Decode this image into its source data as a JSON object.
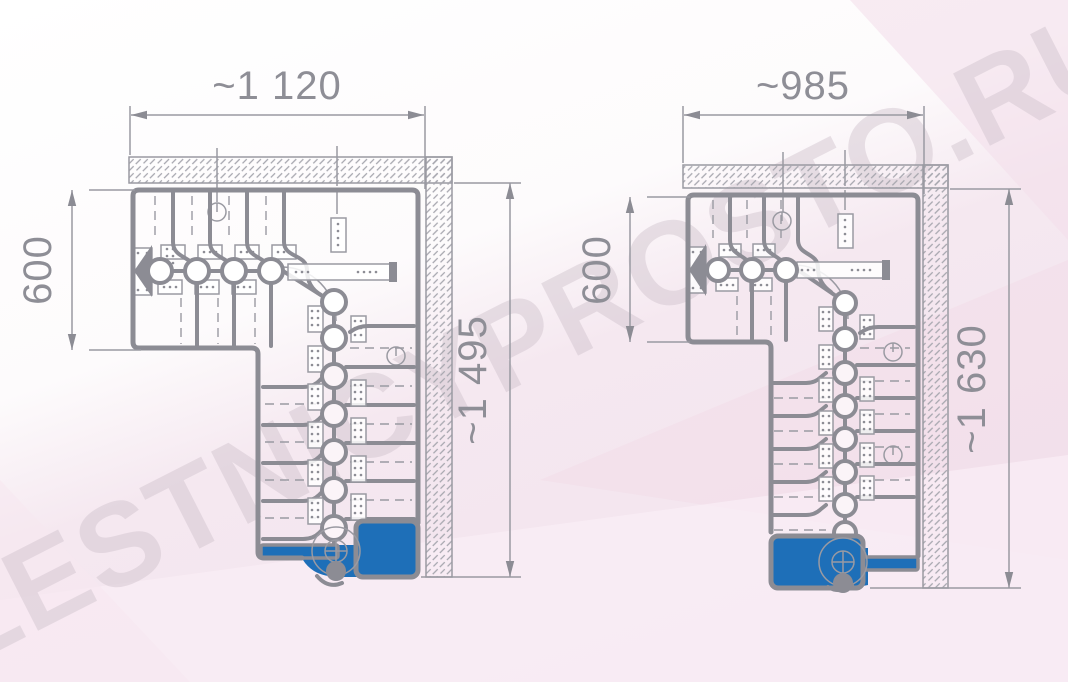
{
  "watermark": {
    "text": "LESTNICYPROSTO.RU"
  },
  "colors": {
    "accent_blue": "#1E6FB8",
    "line_gray": "#8C8C94",
    "thin_gray": "#9A9AA2",
    "text_gray": "#8E8E96",
    "watermark_pink": "#CFC2CC",
    "background_pink": "#F5E8F0",
    "hatch_gray": "#A6A6AE"
  },
  "drawings": [
    {
      "name": "left staircase plan (90-degree turn, wall-mounted modular stair)",
      "width_label": "~1 120",
      "flight_width_label": "600",
      "height_label": "~1 495"
    },
    {
      "name": "right staircase plan (90-degree turn, mirrored exit)",
      "width_label": "~985",
      "flight_width_label": "600",
      "height_label": "~1 630"
    }
  ]
}
